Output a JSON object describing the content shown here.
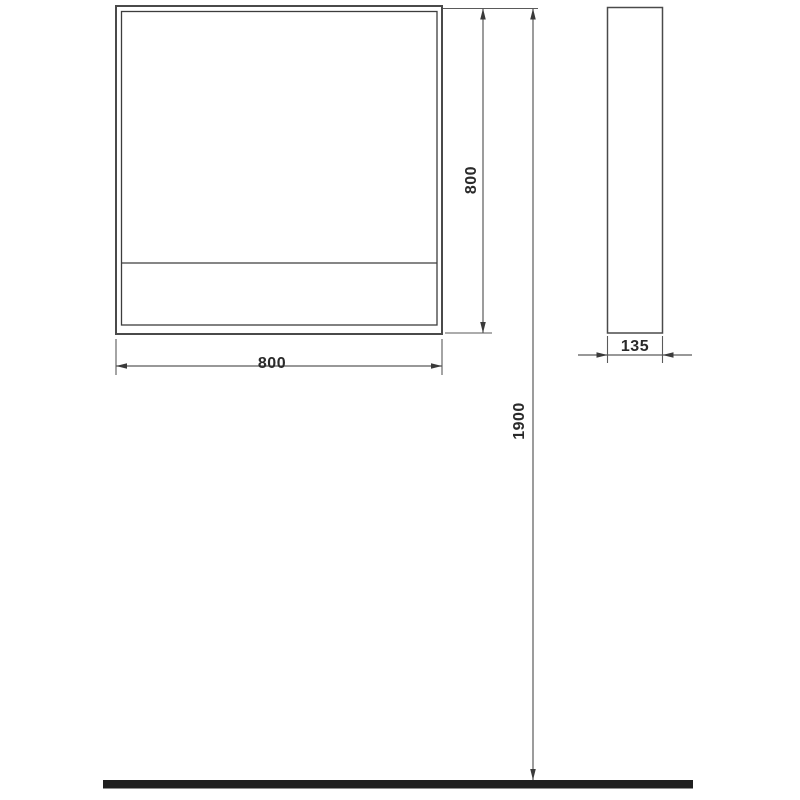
{
  "drawing": {
    "type": "technical-dimension-drawing",
    "subject": "wall mirror cabinet, front and side elevation views with floor reference line"
  },
  "dimensions": {
    "front_width_label": "800",
    "front_height_label": "800",
    "side_depth_label": "135",
    "overall_height_label": "1900"
  },
  "colors": {
    "background": "#ffffff",
    "drawing_line": "#4a4a4a",
    "dimension_line": "#5a5a5a",
    "text": "#2a2a2a",
    "floor": "#1f1f1f"
  }
}
